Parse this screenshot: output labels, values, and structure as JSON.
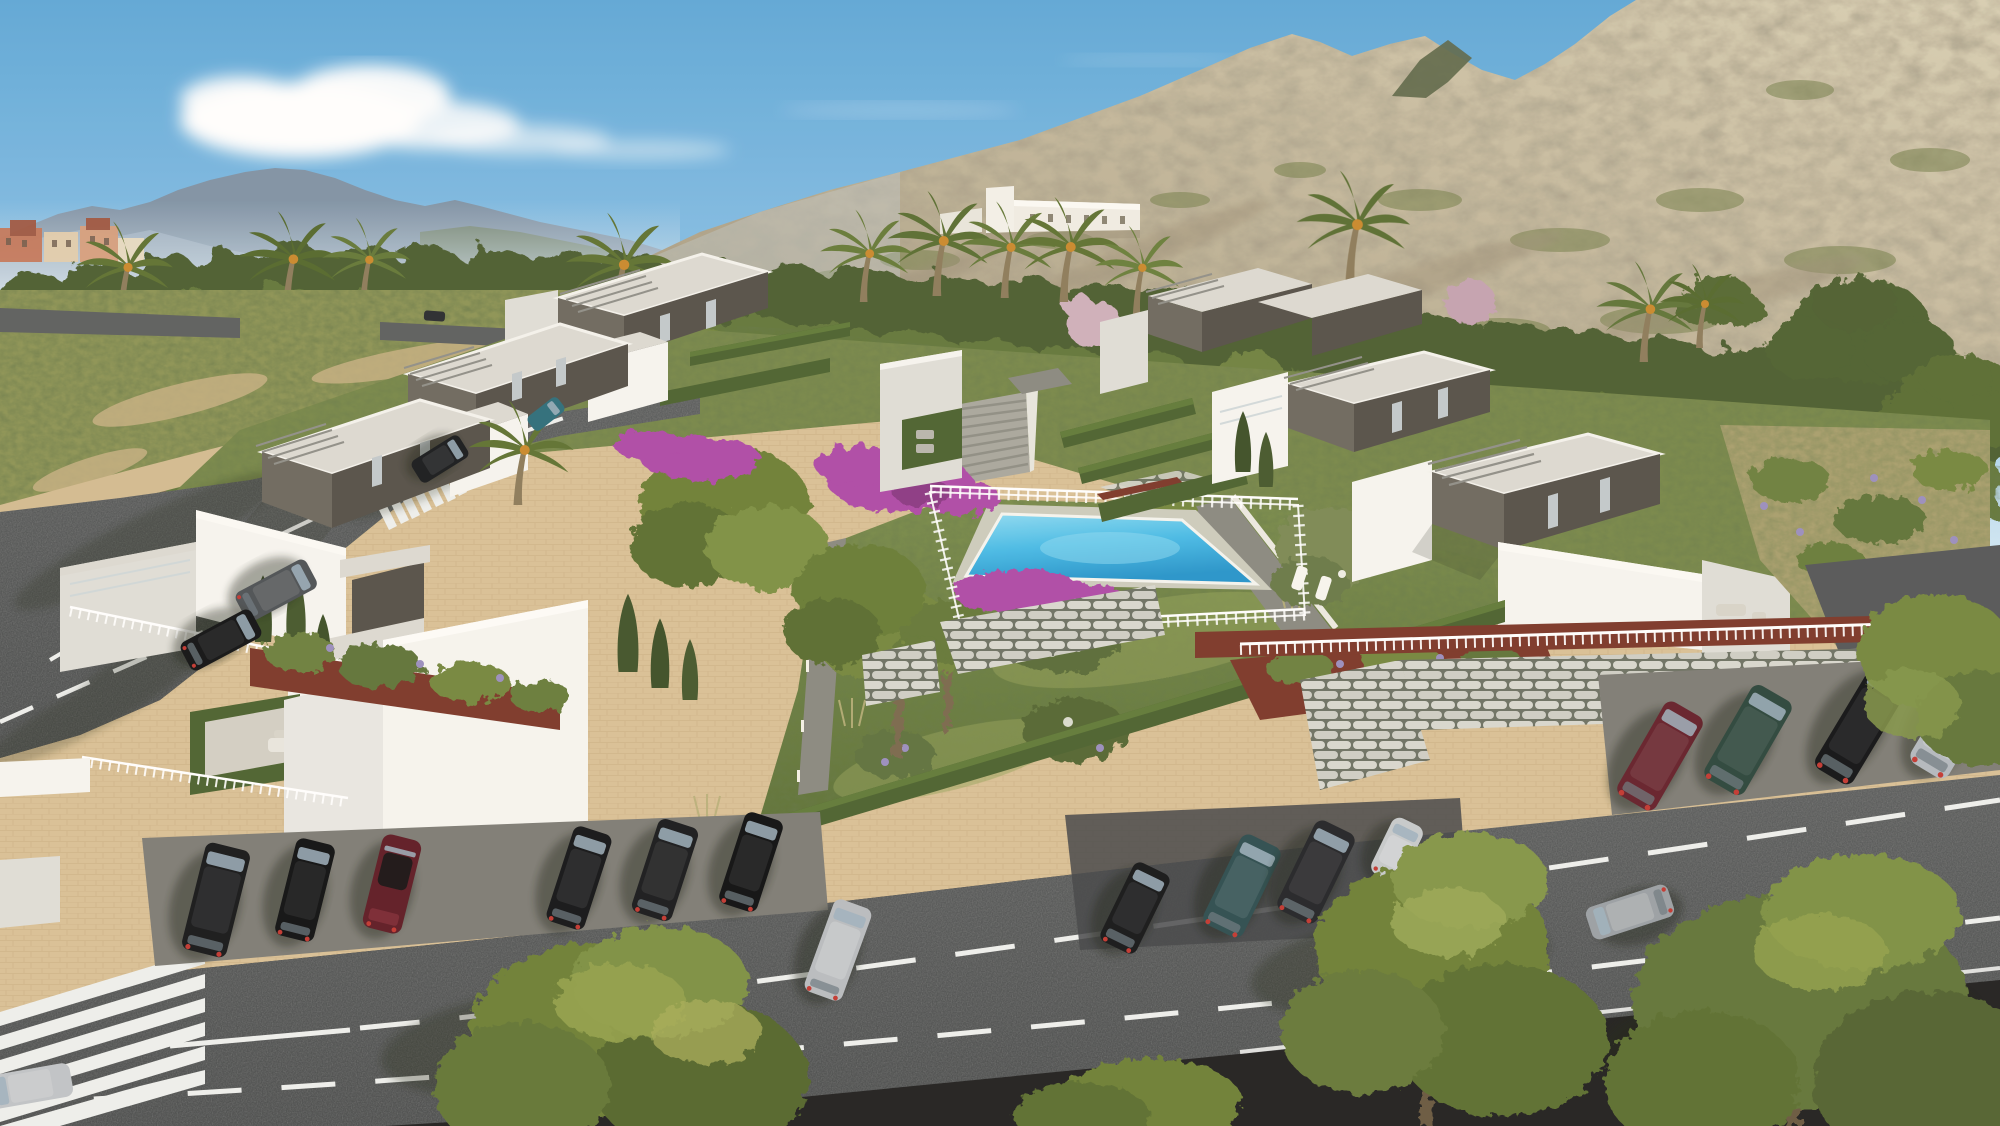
{
  "scene": {
    "type": "3d-architectural-visualization",
    "subject": "modern villa residential development with communal pool",
    "view": "high aerial three-quarter view",
    "environment": "Mediterranean valley, pine park and rocky mountain backdrop",
    "lighting": "warm low sun from the upper right, long soft shadows"
  },
  "colors": {
    "sky_top": "#5fa8d8",
    "sky_mid": "#8ec4e8",
    "sky_horizon": "#ddeef7",
    "cloud": "#ffffff",
    "mountain_far": "#8093a6",
    "mountain_far_light": "#9db0c0",
    "haze": "#c6d8e6",
    "rock_light": "#d8cfb4",
    "rock_mid": "#bcb196",
    "rock_shadow": "#9c9179",
    "rock_scrub": "#75804c",
    "rock_dark_peak": "#5e684a",
    "hill_building": "#f3f1ea",
    "town_orange": "#c5795c",
    "town_cream": "#e3cfae",
    "town_roof": "#a05741",
    "tree_dark": "#4d5f33",
    "tree_mid": "#64783c",
    "tree_light": "#7e9148",
    "tree_highlight": "#9aa957",
    "palm": "#5f7334",
    "palm_trunk": "#8d7c5c",
    "cypress": "#3e5129",
    "blossom": "#c4a3b1",
    "lawn": "#7a8d4d",
    "lawn_light": "#95a35c",
    "lawn_dark": "#5e7339",
    "hedge": "#4d6331",
    "hedge_light": "#617b3b",
    "bougainvillea": "#ae4ba8",
    "bougainvillea_dark": "#8c3a86",
    "pool_light": "#8fdcf4",
    "pool_mid": "#49bce8",
    "pool_deep": "#2795cc",
    "villa_white": "#f6f5f1",
    "villa_white_shade": "#dfded8",
    "villa_white_dark": "#c8c7c0",
    "villa_dark": "#6e6a60",
    "villa_dark_shade": "#56524a",
    "villa_dark_deep": "#47443d",
    "roof_gravel": "#dcdad3",
    "pergola": "#90908a",
    "paver": "#d9c197",
    "paver_light": "#e6d2ab",
    "concrete": "#7e7d77",
    "asphalt": "#4c4f50",
    "asphalt_light": "#5a5d5e",
    "road_line": "#eef0ee",
    "mulch": "#7c392b",
    "block_wall": "#d8d8d0",
    "block_gap": "#6e7365",
    "path_gray": "#8a8a82"
  },
  "landscape": {
    "sky": [
      "large cumulus cloud upper left",
      "thin wisps drifting right"
    ],
    "background": [
      "distant blue-gray mountain range on the left",
      "terracotta town strip on far-left horizon",
      "large sunlit rocky scrub mountain filling the right",
      "white country estate on the hillside"
    ],
    "vegetation": [
      "dense pine tree line",
      "date palms with orange fruit",
      "slender cypresses",
      "pink blossom trees",
      "lavender and white flower beds",
      "magenta bougainvillea around the pool"
    ]
  },
  "development": {
    "villas": {
      "style": "two-storey flat-roof villas: white lower volumes, dark warm-gray upper boxes, gray steel pergolas, gravel roofs",
      "clusters": [
        "terraced left row descending to the avenue",
        "terraced right row facing the central garden"
      ]
    },
    "amenities": [
      "central communal pool with white safety fence",
      "two white sun loungers on the pool deck",
      "landscaped lawn with flower beds",
      "central garden staircase",
      "lamp-lit walkways",
      "openwork concrete retaining walls",
      "white railing fences",
      "red mulch planting strips"
    ],
    "parking": "angled parking bays along the main avenue"
  },
  "roads": {
    "main_avenue": {
      "surface": "two-lane asphalt",
      "markings": [
        "solid then dashed white center line",
        "second dashed lane line",
        "zebra crosswalk at lower left"
      ]
    },
    "side_avenue": {
      "surface": "wide curved asphalt avenue",
      "markings": [
        "two dashed lane lines",
        "zebra crosswalk at upper section"
      ]
    },
    "upper_road": {
      "surface": "distant road behind the tree line"
    }
  },
  "vehicles": {
    "parked_front_row": [
      {
        "type": "suv",
        "color": "#17191c",
        "facing": "rear to road"
      },
      {
        "type": "sedan",
        "color": "#101214",
        "facing": "rear to road"
      },
      {
        "type": "convertible-roadster",
        "color": "#5f1d27",
        "facing": "rear to road"
      }
    ],
    "parked_mid_row": [
      {
        "type": "sedan",
        "color": "#141619",
        "facing": "rear to road"
      },
      {
        "type": "suv",
        "color": "#1a1c1f",
        "facing": "rear to road"
      },
      {
        "type": "sedan",
        "color": "#0f1113",
        "facing": "rear to road"
      },
      {
        "type": "sedan",
        "color": "#b9bdc1",
        "facing": "parallel to road"
      }
    ],
    "parked_echelon": [
      {
        "type": "hatchback",
        "color": "#16181b",
        "facing": "angled bay"
      },
      {
        "type": "suv",
        "color": "#2e4f52",
        "facing": "angled bay"
      },
      {
        "type": "suv",
        "color": "#24262a",
        "facing": "angled bay"
      },
      {
        "type": "microcar",
        "color": "#c6cacd",
        "facing": "angled bay"
      }
    ],
    "parked_upper_right": [
      {
        "type": "hatchback",
        "color": "#65222d",
        "facing": "angled bay"
      },
      {
        "type": "suv",
        "color": "#2c473e",
        "facing": "angled bay"
      },
      {
        "type": "sedan",
        "color": "#121417",
        "facing": "angled bay"
      },
      {
        "type": "coupe",
        "color": "#b4bac0",
        "facing": "angled bay"
      }
    ],
    "driving": [
      {
        "type": "estate",
        "color": "#4e5357",
        "location": "side avenue, heading up"
      },
      {
        "type": "sedan",
        "color": "#121416",
        "location": "side avenue, heading up"
      },
      {
        "type": "compact",
        "color": "#1a1d20",
        "location": "near upper crosswalk"
      },
      {
        "type": "compact",
        "color": "#2e6f7c",
        "location": "top of side avenue"
      },
      {
        "type": "compact",
        "color": "#2a2d31",
        "location": "distant upper road"
      },
      {
        "type": "sedan",
        "color": "#9ba1a6",
        "location": "main avenue, lower right"
      },
      {
        "type": "sedan",
        "color": "#c0c4c8",
        "location": "bottom-left corner, partially cropped"
      }
    ]
  }
}
